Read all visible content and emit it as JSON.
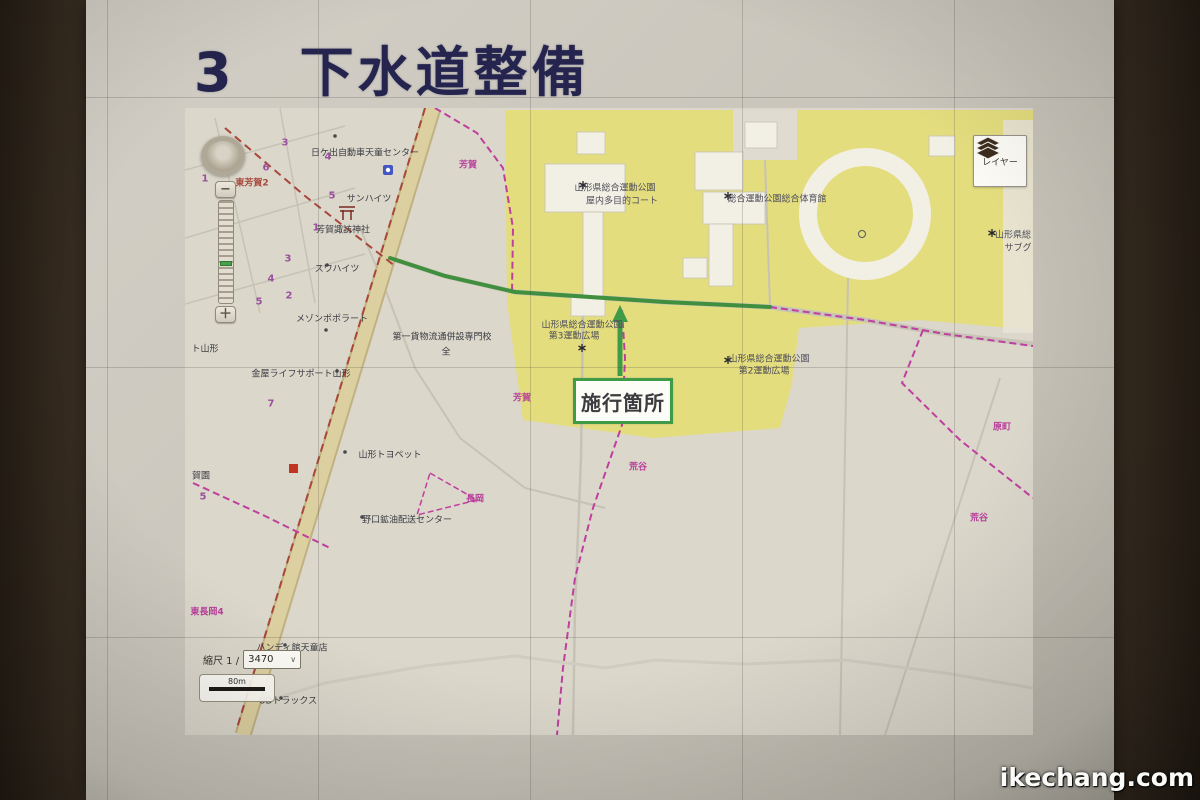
{
  "slide": {
    "title_number": "3",
    "title_text": "下水道整備"
  },
  "watermark": "ikechang.com",
  "map": {
    "layer_button": {
      "label": "レイヤー"
    },
    "zoom_control": {
      "zoom_out": "−",
      "zoom_in": "＋"
    },
    "scale_control": {
      "prefix": "縮尺 1 /",
      "value": "3470",
      "bar_label": "80m"
    },
    "callout": {
      "label": "施行箇所"
    },
    "colors": {
      "accent_green": "#3f9b48",
      "boundary_pink": "#bf3f9f",
      "boundary_brick": "#a8473a",
      "park_yellow": "#e4dd7e",
      "title_navy": "#24244e"
    },
    "labels": [
      {
        "text": "日ケ出自動車天童センター"
      },
      {
        "text": "芳賀"
      },
      {
        "text": "東芳賀2"
      },
      {
        "text": "サンハイツ"
      },
      {
        "text": "芳賀諏訪神社"
      },
      {
        "text": "スワハイツ"
      },
      {
        "text": "メゾンポポラート"
      },
      {
        "text": "第一貨物流通併設専門校"
      },
      {
        "text": "全"
      },
      {
        "text": "金屋ライフサポート山形"
      },
      {
        "text": "ト山形"
      },
      {
        "text": "山形トヨペット"
      },
      {
        "text": "野口鉱油配送センター"
      },
      {
        "text": "ハンディ館天童店"
      },
      {
        "text": "UDトラックス"
      },
      {
        "text": "東長岡4"
      },
      {
        "text": "芳賀"
      },
      {
        "text": "荒谷"
      },
      {
        "text": "原町"
      },
      {
        "text": "荒谷"
      },
      {
        "text": "山形県総合運動公園"
      },
      {
        "text": "屋内多目的コート"
      },
      {
        "text": "総合運動公園総合体育館"
      },
      {
        "text": "山形県総"
      },
      {
        "text": "サブグ"
      },
      {
        "text": "山形県総合運動公園"
      },
      {
        "text": "第3運動広場"
      },
      {
        "text": "山形県総合運動公園"
      },
      {
        "text": "第2運動広場"
      },
      {
        "text": "長岡"
      },
      {
        "text": "賀園"
      }
    ],
    "numbers": [
      "3",
      "4",
      "6",
      "1",
      "5",
      "1",
      "3",
      "4",
      "2",
      "5",
      "7",
      "5"
    ]
  }
}
